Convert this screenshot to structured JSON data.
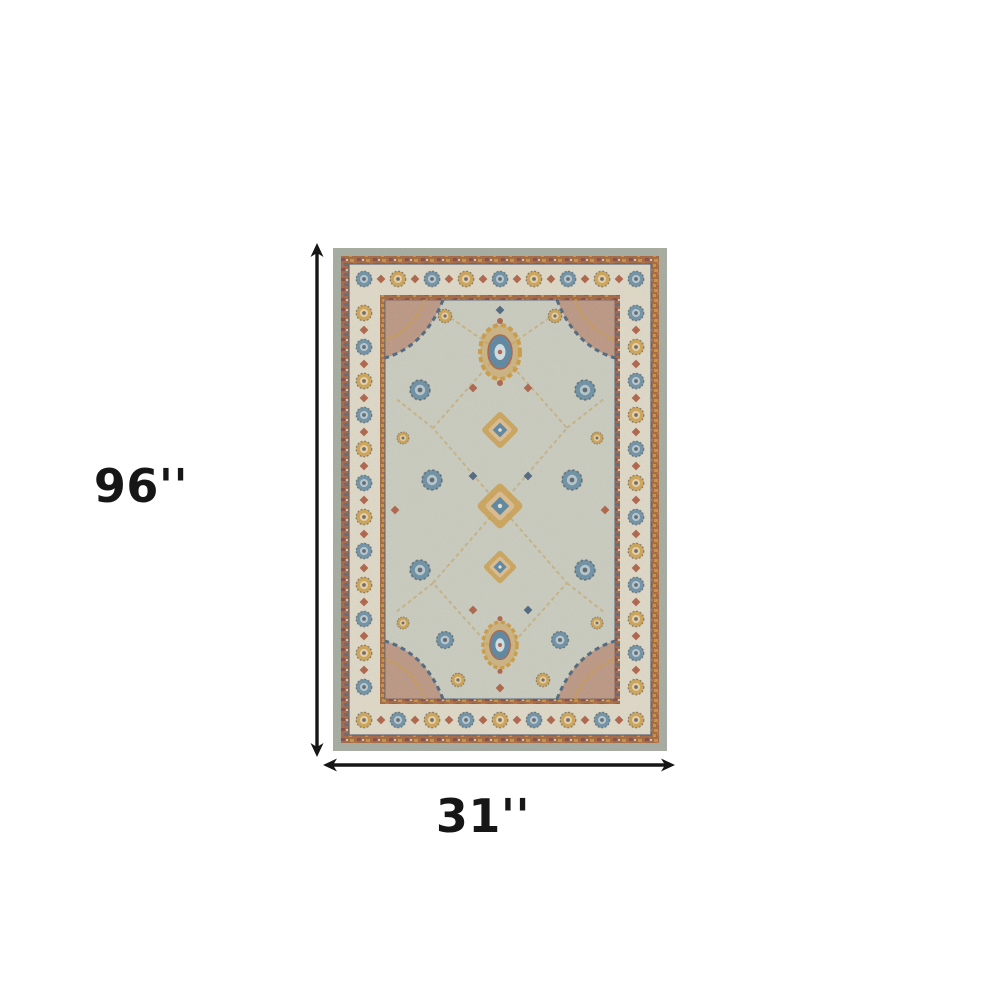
{
  "page": {
    "background_color": "#ffffff"
  },
  "diagram": {
    "type": "product-dimensions",
    "height_label": "96''",
    "width_label": "31''",
    "arrow_color": "#161616"
  },
  "rug": {
    "name": "ornate-traditional-area-rug",
    "colors": {
      "outer_gray": "#9fa69b",
      "band_rust": "#9e5a31",
      "band_gold": "#c28a2e",
      "band_copper": "#b4652c",
      "band_maroon": "#7a3c34",
      "band_navy": "#4d5e7c",
      "border_cream": "#ded8c5",
      "field": "#c6cabd",
      "motif_blue": "#4d7d9a",
      "motif_gold": "#c99434",
      "motif_rust": "#a8563a",
      "motif_navy": "#3e5a74",
      "motif_peach": "#d9b98a",
      "motif_ice": "#cfdfe4",
      "vine_tan": "#c2a468",
      "outline_navy": "#45546b"
    }
  }
}
